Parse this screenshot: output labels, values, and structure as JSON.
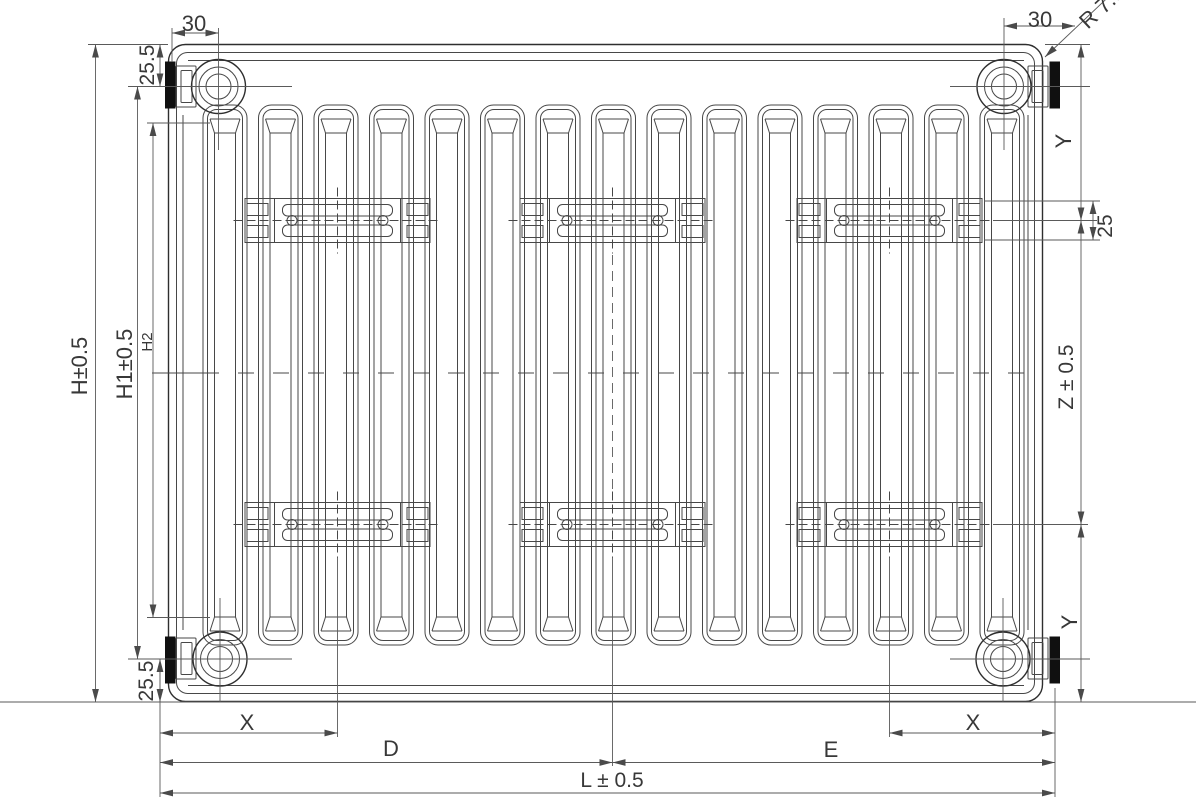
{
  "drawing": {
    "type": "radiator-dimension-drawing",
    "labels": {
      "pitch_left": "30",
      "pitch_right": "30",
      "corner_radius": "R 7.5",
      "offset_top": "25.5",
      "offset_bottom": "25.5",
      "h": "H±0.5",
      "h1": "H1±0.5",
      "h2": "H2",
      "y_top": "Y",
      "y_bottom": "Y",
      "bracket_slot": "25",
      "z": "Z ± 0.5",
      "x_left": "X",
      "x_right": "X",
      "d": "D",
      "e": "E",
      "l": "L ± 0.5"
    },
    "structure": {
      "fin_count": 15,
      "bracket_groups": 3,
      "bracket_rows": 2,
      "connection_circles": 4,
      "wall_bracket_bars": 4
    },
    "colors": {
      "background": "#ffffff",
      "line": "#474747",
      "text": "#383838",
      "bracket_bar_fill": "#101010"
    }
  }
}
